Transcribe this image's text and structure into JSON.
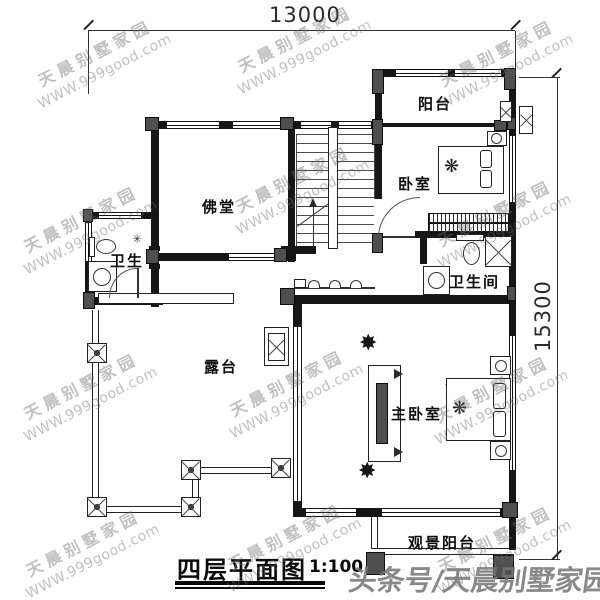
{
  "dimensions": {
    "top": "13000",
    "right": "15300"
  },
  "title": {
    "text": "四层平面图",
    "scale": "1:100"
  },
  "rooms": {
    "buddha_hall": "佛堂",
    "balcony_top": "阳台",
    "bedroom": "卧室",
    "bathroom_right": "卫生间",
    "bathroom_left": "卫生",
    "terrace": "露台",
    "master_bedroom": "主卧室",
    "view_balcony": "观景阳台"
  },
  "watermark": {
    "line1": "天晨别墅家园",
    "line2": "WWW.999good.com"
  },
  "footer_watermark": "头条号/天晨别墅家园",
  "icons": {
    "plant": "✸",
    "throw_blanket": "❋",
    "lamp": "✳"
  }
}
